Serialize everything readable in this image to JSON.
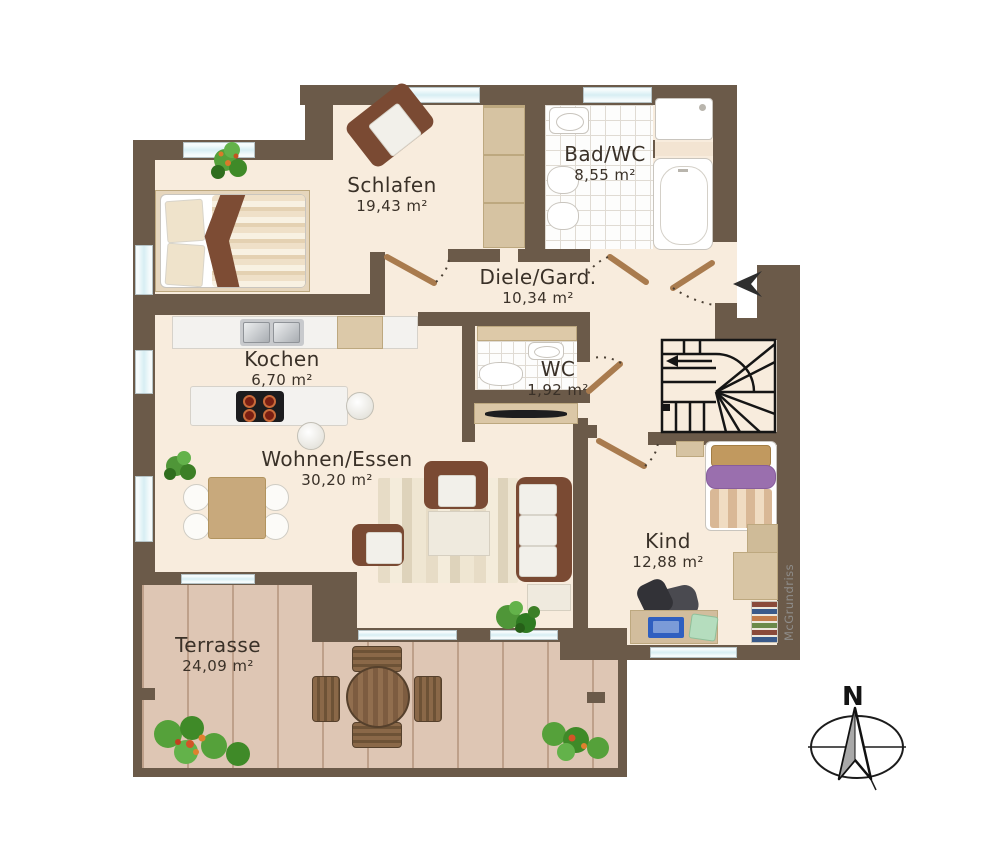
{
  "plan": {
    "title": "Wohnungsgrundriss",
    "watermark": "McGrundriss",
    "compass": {
      "label": "N"
    },
    "rooms": [
      {
        "id": "schlafen",
        "name": "Schlafen",
        "area": "19,43 m²"
      },
      {
        "id": "bad",
        "name": "Bad/WC",
        "area": "8,55 m²"
      },
      {
        "id": "diele",
        "name": "Diele/Gard.",
        "area": "10,34 m²"
      },
      {
        "id": "kochen",
        "name": "Kochen",
        "area": "6,70 m²"
      },
      {
        "id": "wc",
        "name": "WC",
        "area": "1,92 m²"
      },
      {
        "id": "wohnen",
        "name": "Wohnen/Essen",
        "area": "30,20 m²"
      },
      {
        "id": "kind",
        "name": "Kind",
        "area": "12,88 m²"
      },
      {
        "id": "terrasse",
        "name": "Terrasse",
        "area": "24,09 m²"
      }
    ],
    "colors": {
      "wall": "#6b5a49",
      "floor": "#f8ecdd",
      "deck": "#dcc2ae",
      "window_glass": "#d7eef3",
      "door_leaf": "#a97b4e",
      "accent_purple": "#9a6fae",
      "label_text": "#3a3128"
    }
  }
}
